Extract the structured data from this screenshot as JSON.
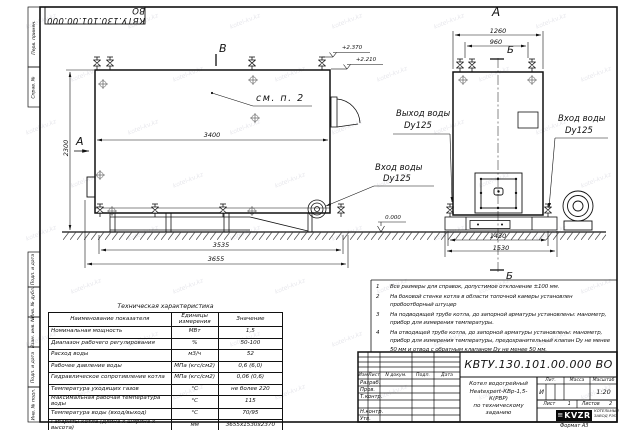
{
  "watermark": "kotel-kv.kz",
  "sheet": {
    "stamp_top": "КВТУ.130.101.00.000  ВО",
    "margin_labels": {
      "perv": "Перв. примен.",
      "sprav": "Справ. №",
      "podp1": "Подп. и дата",
      "inv_dubl": "Инв. № дубл.",
      "vzam": "Взам. инв. №",
      "podp2": "Подп. и дата",
      "inv_podl": "Инв. № подл."
    }
  },
  "side_view": {
    "view_b_label": "В",
    "view_a_label": "А",
    "see_note": "см. п. 2",
    "dim_top": "3400",
    "dim_height": "2300",
    "dim_base": "3535",
    "dim_overall": "3655",
    "elev_high": "+2.370",
    "elev_mid": "+2.210",
    "elev_zero": "0.000",
    "inlet_line1": "Вход воды",
    "inlet_line2": "Dy125"
  },
  "front_view": {
    "view_label": "А",
    "section_top": "Б",
    "section_bottom": "Б",
    "dim_top_outer": "1260",
    "dim_top_inner": "960",
    "dim_base_inner": "1430",
    "dim_base_outer": "1530",
    "outlet_line1": "Выход воды",
    "outlet_line2": "Dy125",
    "inlet_line1": "Вход воды",
    "inlet_line2": "Dy125"
  },
  "notes": [
    {
      "n": "1",
      "text": "Все размеры для справок, допустимое отклонение  ±100 мм."
    },
    {
      "n": "2",
      "text": "На боковой стенке котла в области топочной камеры установлен пробоотборный штуцер"
    },
    {
      "n": "3",
      "text": "На  подводящей трубе котла, до запорной арматуры установлены: манометр, прибор для измерения температуры."
    },
    {
      "n": "4",
      "text": "На отводящей трубе котла, до запорной арматуры установлены: манометр, прибор для измерения температуры, предохранительный клапан Dу не менее 50 мм и отвод с обратным клапаном Dу не менее 50 мм."
    }
  ],
  "spec_table": {
    "title": "Техническая характеристика",
    "headers": [
      "Наименование показателя",
      "Единицы измерения",
      "Значение"
    ],
    "rows": [
      [
        "Номинальная мощность",
        "МВт",
        "1,5"
      ],
      [
        "Диапазон рабочего регулирования",
        "%",
        "50-100"
      ],
      [
        "Расход воды",
        "м3/ч",
        "52"
      ],
      [
        "Рабочее давление воды",
        "МПа (кгс/см2)",
        "0,6 (6,0)"
      ],
      [
        "Гидравлическое сопротивление котла",
        "МПа (кгс/см2)",
        "0,06 (0,6)"
      ],
      [
        "Температура уходящих газов",
        "°С",
        "не более 220"
      ],
      [
        "Максимальная рабочая температура воды",
        "°С",
        "115"
      ],
      [
        "Температура воды (вход/выход)",
        "°С",
        "70/95"
      ],
      [
        "Габариты котла (длина х ширина х высота)",
        "мм",
        "3655х1530х2370"
      ]
    ]
  },
  "title_block": {
    "designation": "КВТУ.130.101.00.000  ВО",
    "doc_name": [
      "Котел водогрейный",
      "Heatexpert-КВр-1,5-К(РВР)",
      "по техническому заданию"
    ],
    "col_headers": [
      "Изм",
      "Лист",
      "N докум.",
      "Подп.",
      "Дата"
    ],
    "row_labels": [
      "Разраб.",
      "Пров.",
      "Т.контр.",
      "Н.контр.",
      "Утв."
    ],
    "lit_header": "Лит.",
    "mass_header": "Масса",
    "scale_header": "Масштаб",
    "lit_value": "И",
    "scale_value": "1:20",
    "sheet_label": "Лист",
    "sheet_value": "1",
    "sheets_label": "Листов",
    "sheets_value": "2",
    "logo_glyph": "≡",
    "logo_text": "KVZR",
    "company": [
      "КОТЕЛЬНЫЙ",
      "ЗАВОД РЭП"
    ],
    "format_label": "Формат  А3"
  }
}
